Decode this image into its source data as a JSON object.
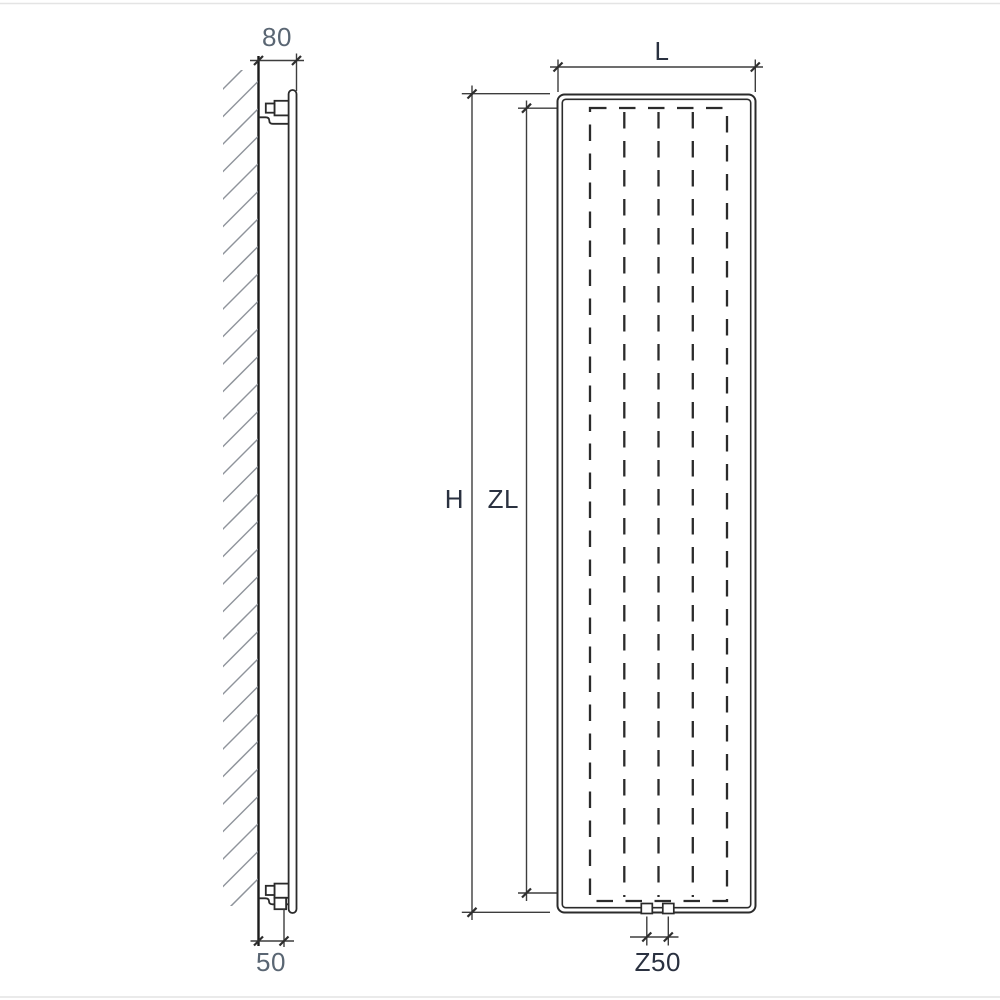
{
  "labels": {
    "side_depth": "80",
    "side_bottom_offset": "50",
    "front_width": "L",
    "front_height": "H",
    "front_inner_height": "ZL",
    "front_connection_spacing": "Z50"
  },
  "colors": {
    "background": "#ffffff",
    "line": "#2b2b2b",
    "wall": "#1b1b1b",
    "dim": "#3d3d3d",
    "tick": "#2e2e2e",
    "hatch": "#8f949b",
    "label_dark": "#2a3140",
    "label_light": "#5a6673",
    "frame": "#e4e4e4"
  }
}
